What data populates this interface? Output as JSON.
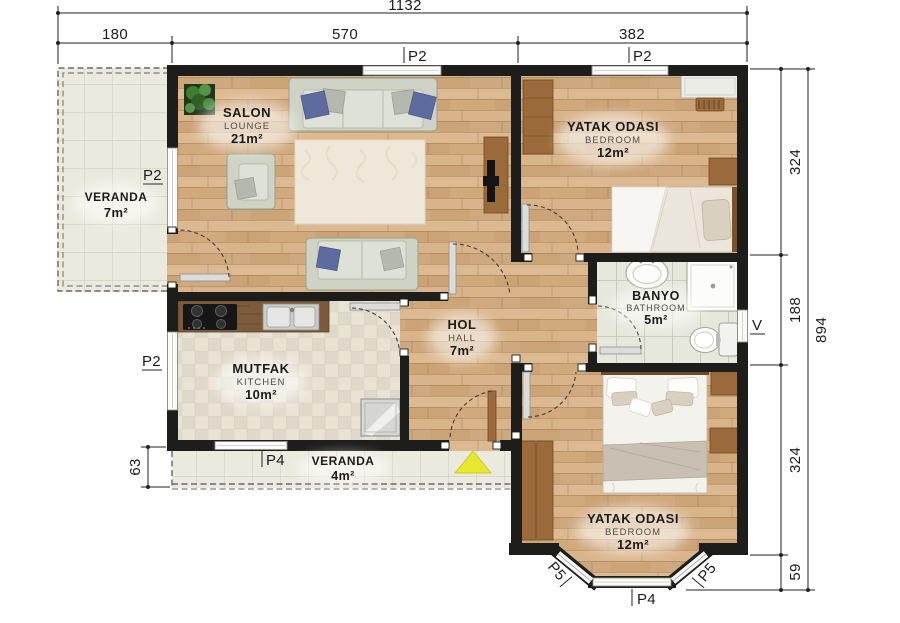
{
  "dimensions": {
    "top_total": "1132",
    "top_left": "180",
    "top_mid": "570",
    "top_right": "382",
    "right_1": "324",
    "right_2": "188",
    "right_3": "324",
    "right_4": "59",
    "right_total": "894",
    "left_bottom": "63"
  },
  "labels": {
    "p2": "P2",
    "p4": "P4",
    "p5": "P5",
    "v": "V"
  },
  "rooms": {
    "veranda_left": {
      "name": "VERANDA",
      "area": "7m²"
    },
    "salon": {
      "name": "SALON",
      "sub": "LOUNGE",
      "area": "21m²"
    },
    "bedroom_top": {
      "name": "YATAK ODASI",
      "sub": "BEDROOM",
      "area": "12m²"
    },
    "bathroom": {
      "name": "BANYO",
      "sub": "BATHROOM",
      "area": "5m²"
    },
    "hall": {
      "name": "HOL",
      "sub": "HALL",
      "area": "7m²"
    },
    "kitchen": {
      "name": "MUTFAK",
      "sub": "KITCHEN",
      "area": "10m²"
    },
    "veranda_bottom": {
      "name": "VERANDA",
      "area": "4m²"
    },
    "bedroom_bottom": {
      "name": "YATAK ODASI",
      "sub": "BEDROOM",
      "area": "12m²"
    }
  },
  "colors": {
    "wall": "#1d1d1b",
    "wood_floor": "#d8b286",
    "kitchen_tile": "#e9e3d4",
    "bath_tile": "#e6e8dc",
    "veranda_tile": "#eceade",
    "entrance_arrow": "#e8e92f",
    "pillow_blue": "#5d6b9e",
    "furniture_brown": "#9a6a3a",
    "counter_wood": "#7d5a3b"
  }
}
